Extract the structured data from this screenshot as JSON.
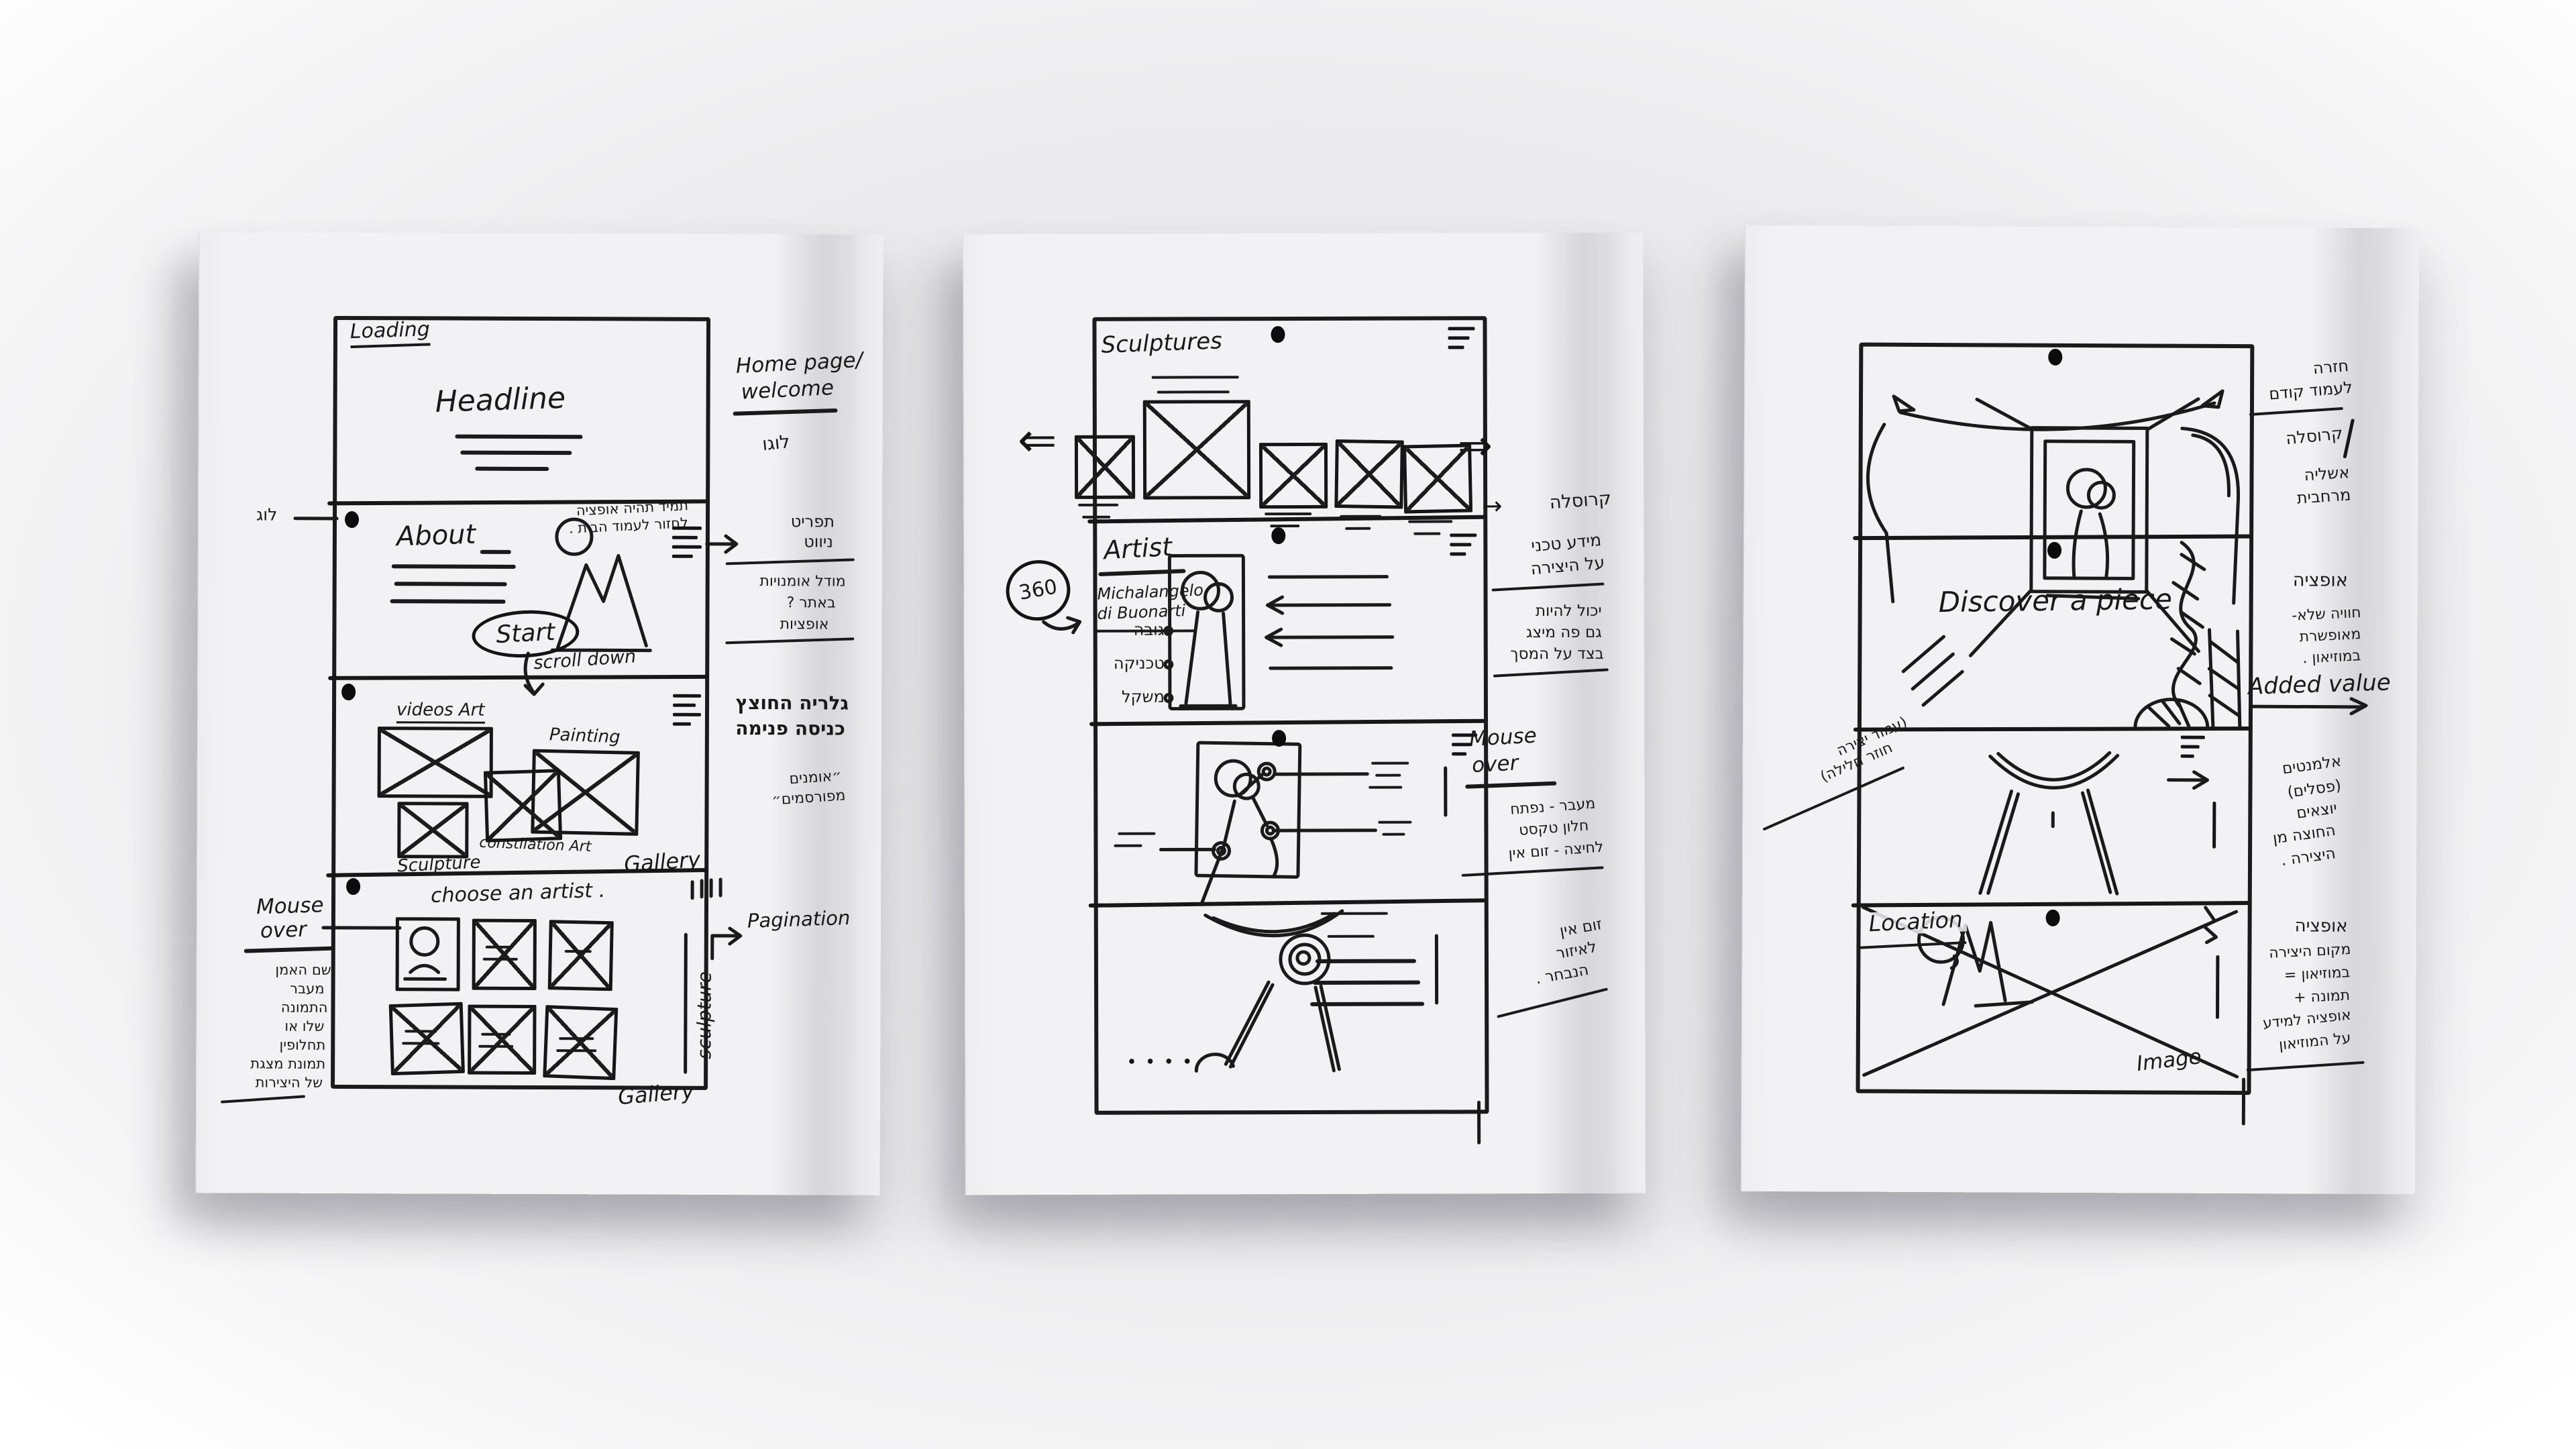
{
  "glyphs": {
    "arrow_right": "→",
    "arrow_down": "↓",
    "double_left": "⇐",
    "double_right": "⇒",
    "dots": "• • • •"
  },
  "paper1": {
    "loading": "Loading",
    "headline": "Headline",
    "home_note_1": "תמיד תהיה אופציה",
    "home_note_2": "לחזור לעמוד הבית .",
    "log": "לוג",
    "about": "About",
    "start": "Start",
    "scroll": "scroll down",
    "videos_art": "videos Art",
    "painting": "Painting",
    "constellation": "constilation Art",
    "sculpture": "Sculpture",
    "gallery": "Gallery",
    "choose": "choose an artist .",
    "gallery_bottom": "Gallery",
    "sculpture_side": "sculpture",
    "pagination": "Pagination",
    "mouse_over_1": "Mouse",
    "mouse_over_2": "over",
    "mouse_list": [
      "שם האמן",
      "מעבר",
      "התמונה",
      "שלו או",
      "תחלופין",
      "תמונת מצגת",
      "של היצירות"
    ],
    "margin": {
      "home_1": "Home page/",
      "home_2": "welcome",
      "logo": "לוגו",
      "menu_1": "תפריט",
      "menu_2": "ניווט",
      "model_1": "מודל אומנויות",
      "model_2": "באתר ?",
      "model_3": "אופציות",
      "gallery_1": "גלריה החוצץ",
      "gallery_2": "כניסה פנימה",
      "famous_1": "״אומנים",
      "famous_2": "מפורסמים״"
    }
  },
  "paper2": {
    "title": "Sculptures",
    "carousel": "קרוסלה",
    "artist": "Artist",
    "artist_name_1": "Michalangelo",
    "artist_name_2": "di Buonarti",
    "deg360": "360",
    "specs": [
      "גובה",
      "טכניקה",
      "משקל"
    ],
    "info_1": "מידע טכני",
    "info_2": "על היצירה",
    "info_3": "יכול להיות",
    "info_4": "גם פה מיצג",
    "info_5": "בצד על המסך",
    "mouse_over_1": "Mouse",
    "mouse_over_2": "over",
    "mouse_note_1": "מעבר - נפתח",
    "mouse_note_2": "חלון טקסט",
    "mouse_note_3": "לחיצה - זום אין",
    "zoom_1": "זום אין",
    "zoom_2": "לאיזור",
    "zoom_3": "הנבחר ."
  },
  "paper3": {
    "back_1": "חזרה",
    "back_2": "לעמוד קודם",
    "carousel": "קרוסלה",
    "illusion_1": "אשליה",
    "illusion_2": "מרחבית",
    "option": "אופציה",
    "exp_1": "חוויה שלא-",
    "exp_2": "מאופשרת",
    "exp_3": "במוזיאון .",
    "added_value": "Added value",
    "discover": "Discover a piece",
    "loop_1": "(עמוד יצירה",
    "loop_2": "חוזר חלילה)",
    "elements": [
      "אלמנטים",
      "(פסלים)",
      "יוצאים",
      "החוצה מן",
      "היצירה ."
    ],
    "location": "Location",
    "image": "Image",
    "loc_note": [
      "אופציה",
      "מקום היצירה",
      "במוזיאון =",
      "תמונה +",
      "אופציה למידע",
      "על המוזיאון"
    ]
  }
}
